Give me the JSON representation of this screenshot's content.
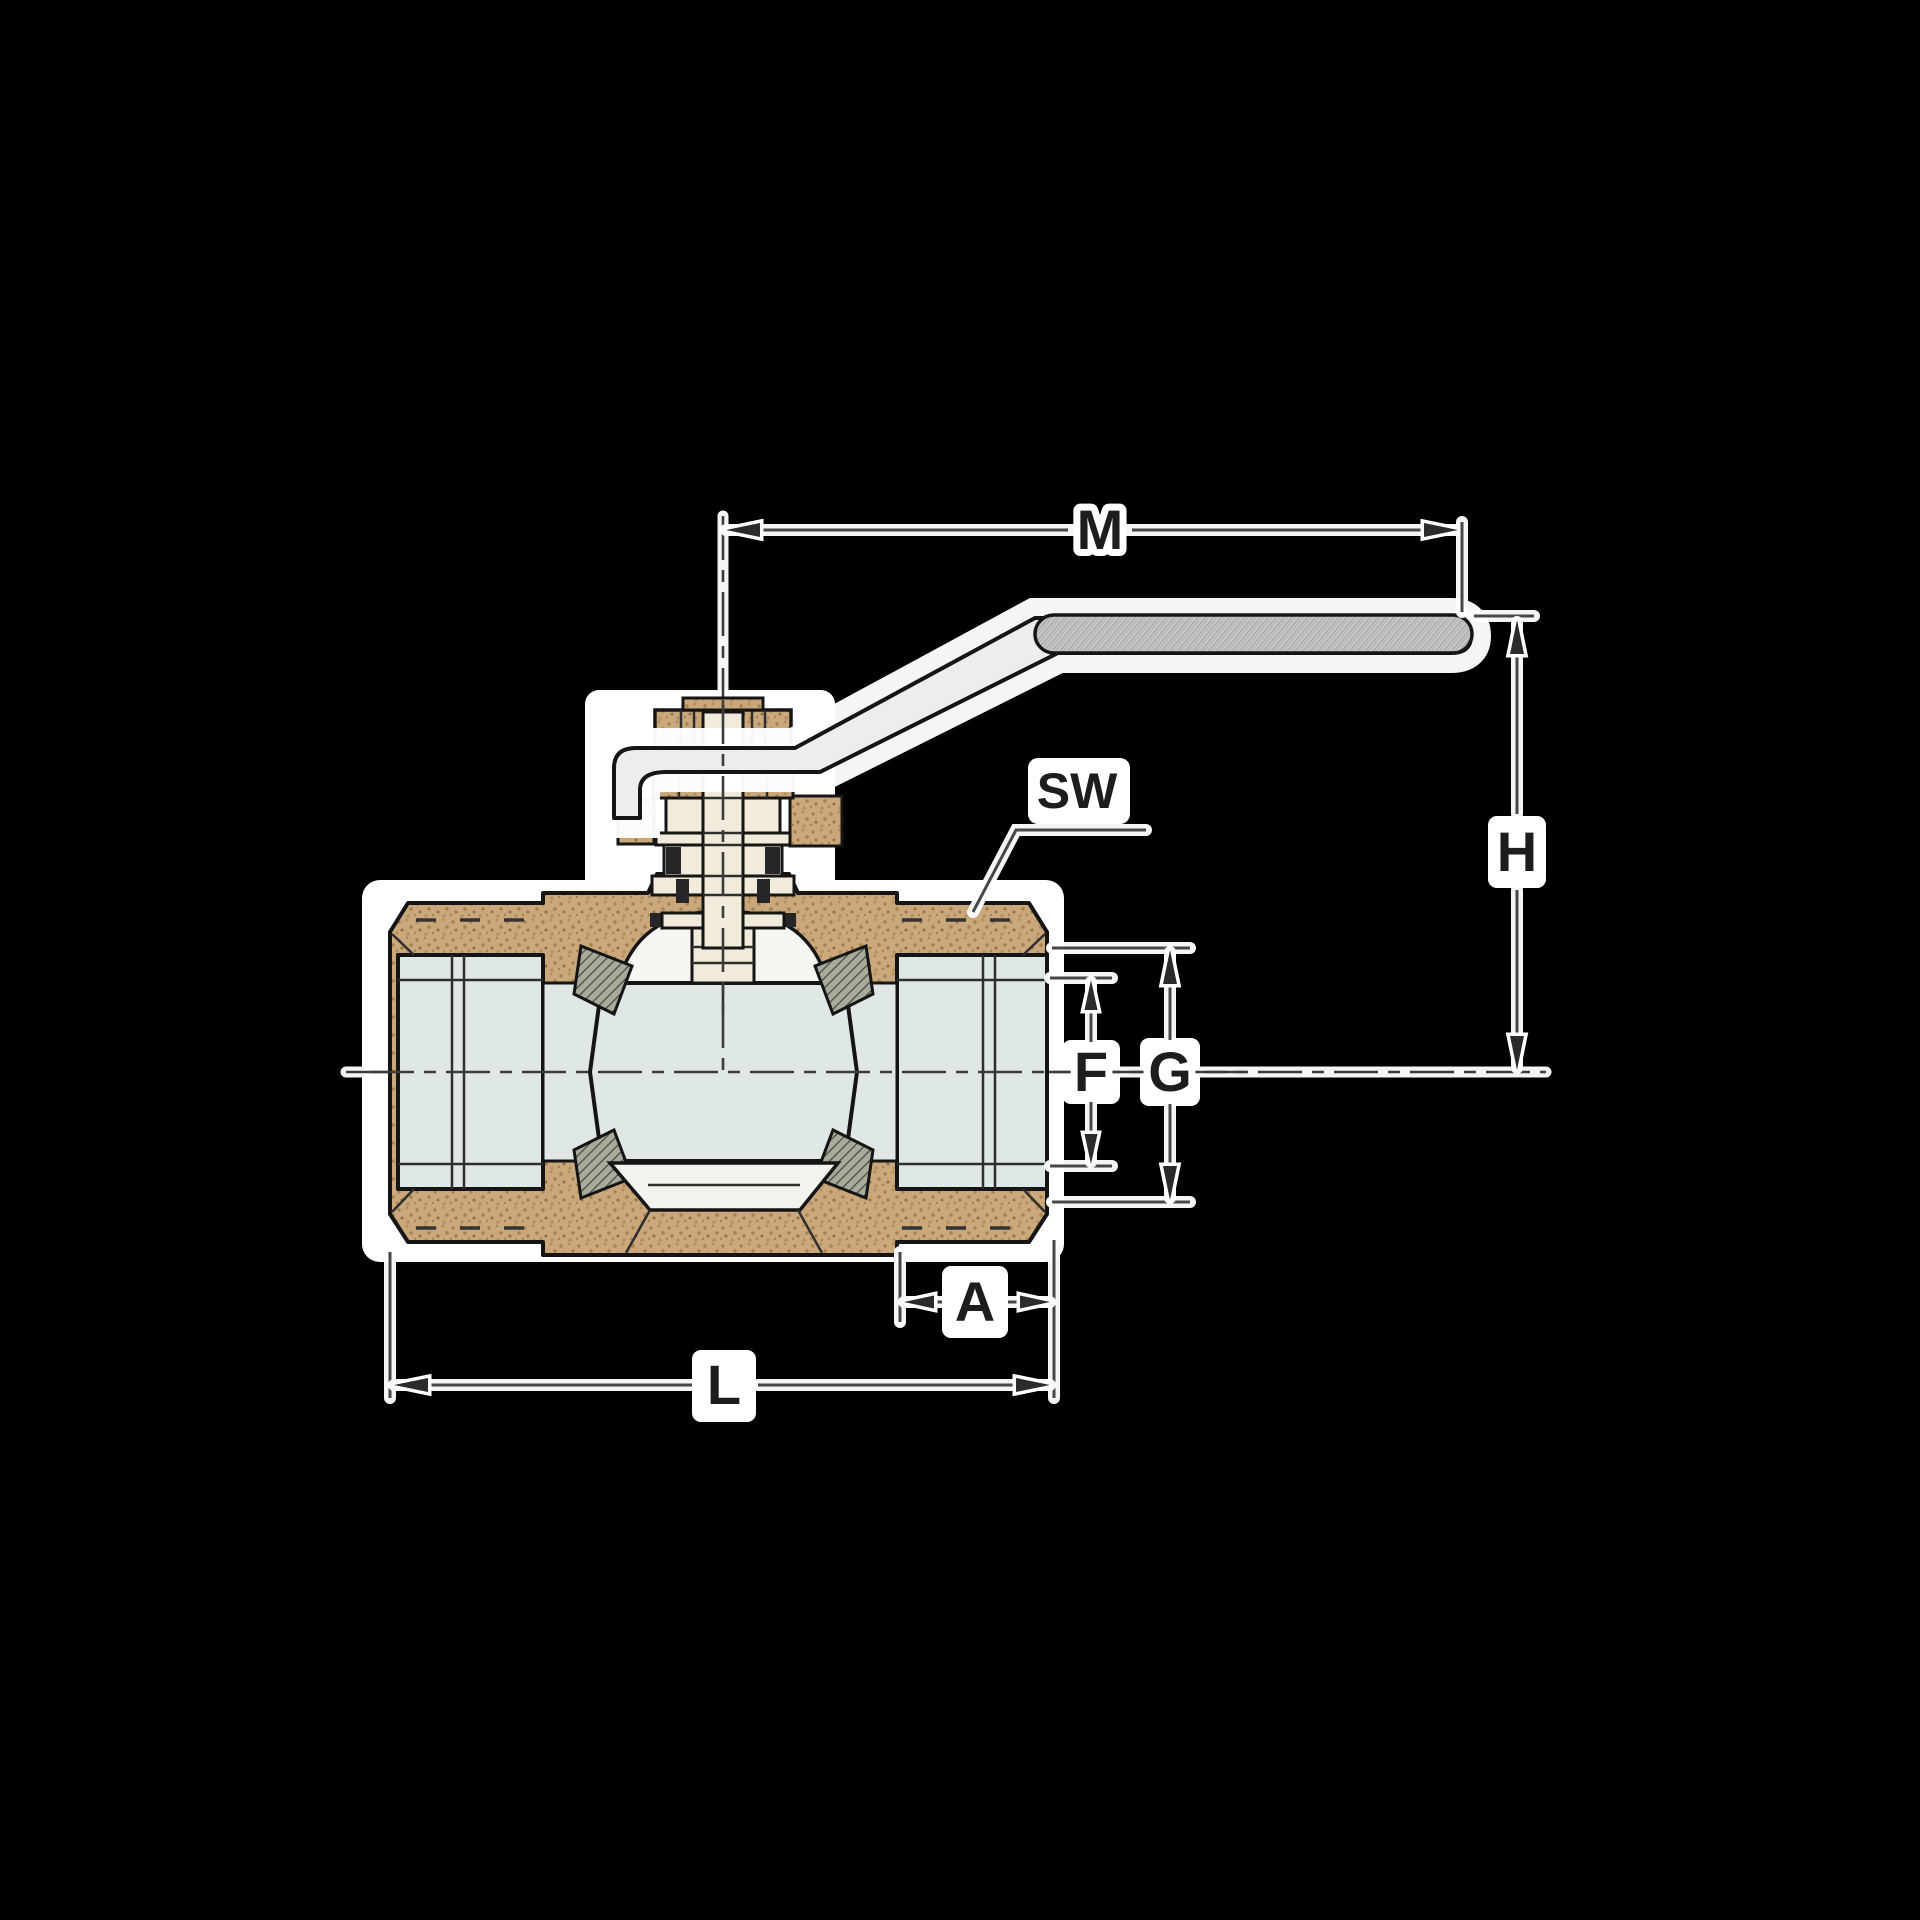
{
  "figure": {
    "type": "technical-sectional-drawing",
    "subject": "two-piece ball valve with lever handle, cross-section with dimension callouts"
  },
  "labels": {
    "m": "M",
    "sw": "SW",
    "h": "H",
    "g": "G",
    "f": "F",
    "a": "A",
    "l": "L"
  },
  "colors": {
    "background": "#000000",
    "paper": "#ffffff",
    "body_bronze": "#caa87c",
    "bronze_speckle": "#a6824f",
    "bore_blue": "#dfe8e6",
    "cream": "#f2ebdb",
    "cavity_white": "#f7f5f0",
    "seat_gray": "#a8ab9c",
    "seal_dark": "#262626",
    "handle_gray": "#ededed",
    "grip_gray": "#c6c6c6",
    "dimension_line": "#474747",
    "label_text": "#1d1d1d"
  }
}
